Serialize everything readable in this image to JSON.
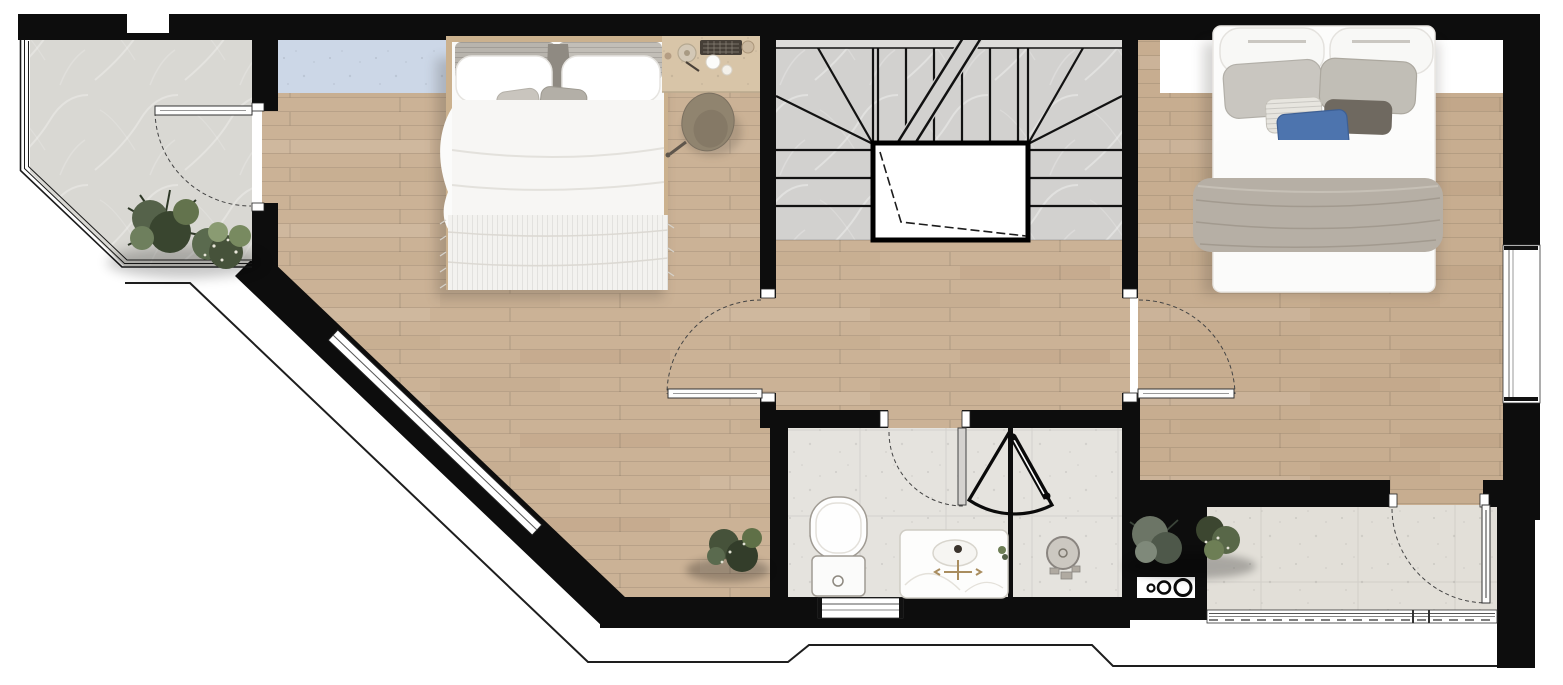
{
  "meta": {
    "kind": "architectural-floor-plan",
    "level": "upper-floor",
    "width_px": 1563,
    "height_px": 685
  },
  "colors": {
    "wall": "#0d0d0d",
    "outline": "#1e1e1e",
    "wood": "#cbb296",
    "wood2": "#c7ad90",
    "balcony": "#d9d8d3",
    "stairs": "#d2d1cf",
    "landing": "#dddcda",
    "tile": "#e5e3de",
    "stone": "#e2dfd8",
    "niche": "#ffffff",
    "skylight": "#ccd7e7",
    "bed_frame": "#cbb18e",
    "desk": "#d8c5a8",
    "chair": "#90846f",
    "blanket": "#b6afa5",
    "pillow_blue": "#4d74ae",
    "plant_dark": "#39452f",
    "plant_mid": "#55624a",
    "plant_light": "#788a60",
    "fixture_gold": "#a98d5f"
  },
  "rooms": [
    {
      "id": "balcony",
      "name": "Balcony (top-left)",
      "floor": "marble tile",
      "features": [
        "glazed corner wall",
        "swing door to bedroom 1",
        "plants"
      ]
    },
    {
      "id": "bedroom1",
      "name": "Bedroom 1 (left)",
      "floor": "wood plank",
      "features": [
        "double bed",
        "desk with accessories",
        "desk chair",
        "skylight strip",
        "diagonal window wall",
        "corner plant"
      ]
    },
    {
      "id": "hallway",
      "name": "Hallway / landing",
      "floor": "wood plank",
      "features": [
        "doors to both bedrooms",
        "door to bathroom"
      ]
    },
    {
      "id": "staircase",
      "name": "Staircase (center)",
      "floor": "marble",
      "features": [
        "winder treads",
        "open stairwell void",
        "section break line"
      ]
    },
    {
      "id": "bathroom",
      "name": "Bathroom (bottom-center)",
      "floor": "stone tile",
      "features": [
        "toilet",
        "vanity sink",
        "glass partition",
        "folding shower door",
        "shower seat",
        "window"
      ]
    },
    {
      "id": "bedroom2",
      "name": "Bedroom 2 (right)",
      "floor": "wood plank",
      "features": [
        "double bed with blue pillow",
        "gray throw blanket",
        "wardrobe niche",
        "side window",
        "door to terrace"
      ]
    },
    {
      "id": "terrace",
      "name": "Terrace (bottom-right)",
      "floor": "stone tile",
      "features": [
        "plants",
        "service box with pipe rings",
        "glazed railing strip",
        "glass door"
      ]
    }
  ],
  "stairs": {
    "top_treads": 6,
    "flank_treads_each_side": 3,
    "void": "open stairwell with break line"
  },
  "doors": [
    {
      "id": "balcony-door",
      "type": "swing",
      "between": [
        "balcony",
        "bedroom1"
      ]
    },
    {
      "id": "bedroom1-door",
      "type": "swing",
      "between": [
        "hallway",
        "bedroom1"
      ]
    },
    {
      "id": "bedroom2-door",
      "type": "swing",
      "between": [
        "hallway",
        "bedroom2"
      ]
    },
    {
      "id": "bathroom-door",
      "type": "swing",
      "between": [
        "hallway",
        "bathroom"
      ]
    },
    {
      "id": "terrace-door",
      "type": "swing-glass",
      "between": [
        "bedroom2",
        "terrace"
      ]
    },
    {
      "id": "shower-door",
      "type": "folding-fan",
      "between": [
        "bathroom",
        "shower"
      ]
    }
  ],
  "windows": [
    {
      "id": "balcony-glazing",
      "location": "balcony left + diagonal + bottom"
    },
    {
      "id": "bedroom1-diagonal-window",
      "location": "bedroom 1 diagonal wall"
    },
    {
      "id": "bedroom2-side-window",
      "location": "right exterior wall"
    },
    {
      "id": "bathroom-window",
      "location": "below toilet"
    },
    {
      "id": "terrace-railing",
      "location": "terrace bottom edge"
    },
    {
      "id": "skylight-panel",
      "location": "bedroom 1 top strip"
    }
  ],
  "service_box": {
    "rings": 3
  }
}
